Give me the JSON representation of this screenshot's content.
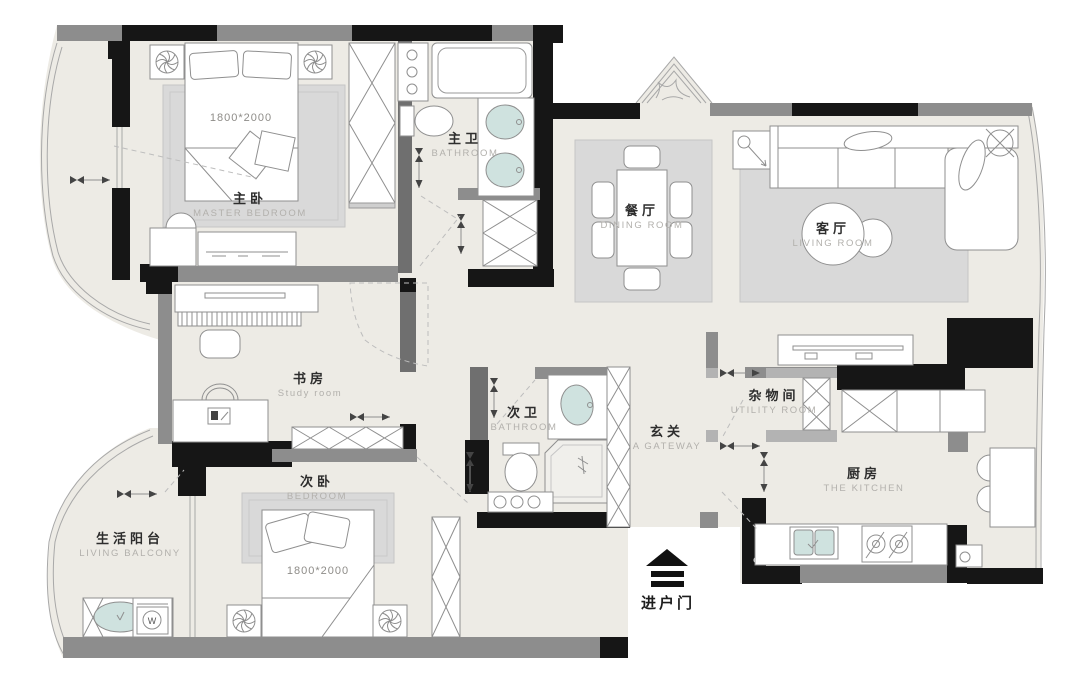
{
  "rooms": {
    "master_bedroom": {
      "zh": "主卧",
      "en": "MASTER BEDROOM",
      "bed_size": "1800*2000"
    },
    "master_bathroom": {
      "zh": "主卫",
      "en": "BATHROOM"
    },
    "dining_room": {
      "zh": "餐厅",
      "en": "DINING ROOM"
    },
    "living_room": {
      "zh": "客厅",
      "en": "LIVING ROOM"
    },
    "study_room": {
      "zh": "书房",
      "en": "Study room"
    },
    "second_bathroom": {
      "zh": "次卫",
      "en": "BATHROOM"
    },
    "gateway": {
      "zh": "玄关",
      "en": "A GATEWAY"
    },
    "utility_room": {
      "zh": "杂物间",
      "en": "UTILITY ROOM"
    },
    "kitchen": {
      "zh": "厨房",
      "en": "THE KITCHEN"
    },
    "second_bedroom": {
      "zh": "次卧",
      "en": "BEDROOM",
      "bed_size": "1800*2000"
    },
    "living_balcony": {
      "zh": "生活阳台",
      "en": "LIVING BALCONY"
    }
  },
  "entrance": {
    "label": "进户门"
  },
  "appliances": {
    "washer_label": "W"
  },
  "colors": {
    "wall_black": "#161616",
    "wall_gray": "#8d8d8d",
    "floor": "#edebe5",
    "rug": "#d9d9d9",
    "fixture_teal": "#cfe2df",
    "outline": "#8f8f8f",
    "label_zh": "#2d2d2d",
    "label_en": "#b2b0ac"
  }
}
